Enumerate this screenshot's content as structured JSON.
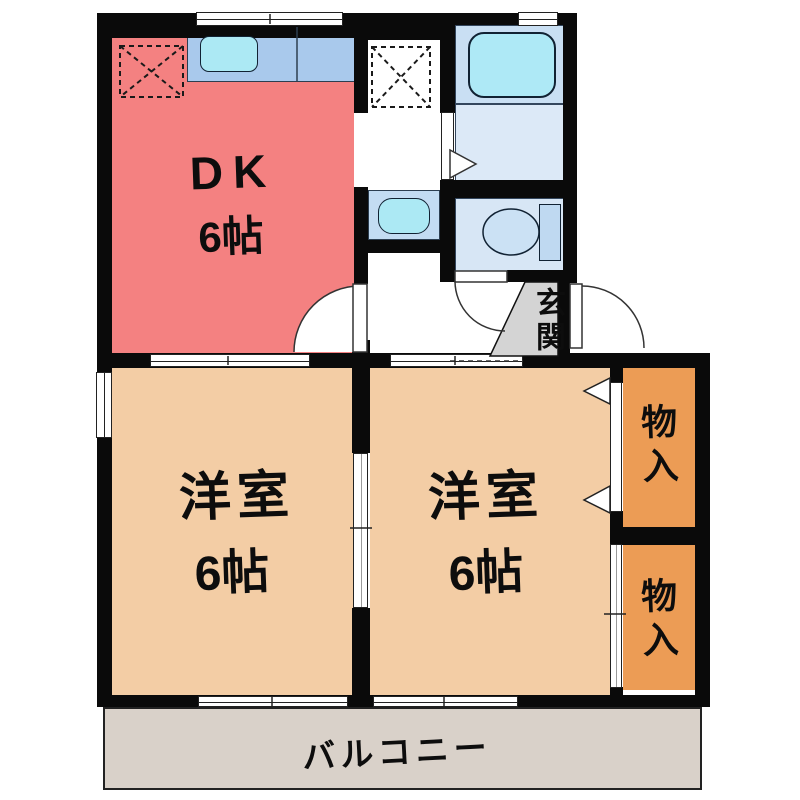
{
  "floorplan": {
    "type": "japanese-apartment-floor-plan",
    "rooms": {
      "dk": {
        "label": "DK",
        "size": "6帖",
        "color": "#F48181"
      },
      "west_left": {
        "label": "洋室",
        "size": "6帖",
        "color": "#F3CDA5"
      },
      "west_right": {
        "label": "洋室",
        "size": "6帖",
        "color": "#F3CDA5"
      },
      "closet_upper": {
        "label": "物入",
        "color": "#EC9C55"
      },
      "closet_lower": {
        "label": "物入",
        "color": "#EC9C55"
      },
      "genkan": {
        "label": "玄関",
        "color": "#D4D4D4"
      },
      "balcony": {
        "label": "バルコニー",
        "color": "#D9D1C9"
      },
      "bathroom": {
        "color": "#C9DFF3"
      },
      "washroom": {
        "color": "#DCE9F7"
      },
      "toilet_room": {
        "color": "#D7E6F5"
      }
    },
    "fixtures": [
      "kitchen-counter",
      "kitchen-sink",
      "refrigerator-space",
      "washing-machine-space",
      "bathtub",
      "washbasin",
      "toilet",
      "entrance-door",
      "dk-door",
      "toilet-door",
      "sliding-partition",
      "closet-bifold-door",
      "closet-sliding-door"
    ],
    "palette": {
      "wall": "#0a0a0a",
      "fixture_blue": "#A9C9EC",
      "fixture_cyan": "#ACE9F4",
      "text": "#0d0d0d"
    }
  }
}
